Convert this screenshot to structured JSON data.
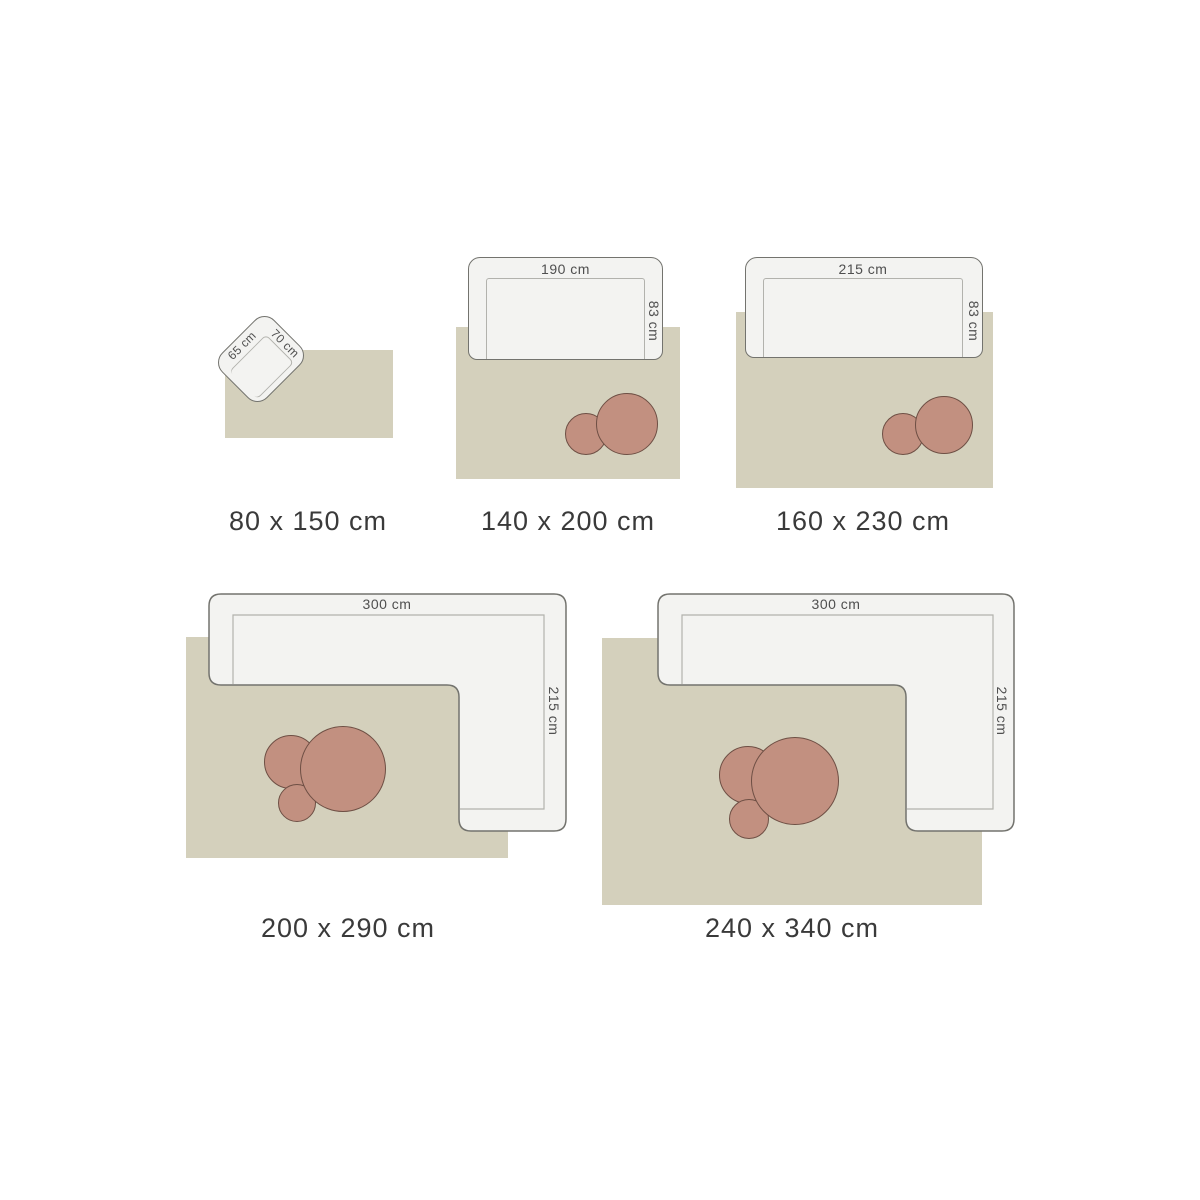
{
  "title": "Rug size guide diagram",
  "colors": {
    "background": "#ffffff",
    "rug_fill": "#d4d0bc",
    "sofa_fill": "#f3f3f1",
    "sofa_border": "#73736e",
    "seat_line": "#b2b2ad",
    "table_fill": "#c29080",
    "table_border": "#6e4f44",
    "size_label_text": "#3a3a3a",
    "dimension_text": "#4f4f4f"
  },
  "items": [
    {
      "size_label": "80 x 150 cm",
      "furniture": "armchair",
      "chair_width_label": "70 cm",
      "chair_depth_label": "65 cm"
    },
    {
      "size_label": "140 x 200 cm",
      "furniture": "sofa",
      "sofa_width_label": "190 cm",
      "sofa_depth_label": "83 cm"
    },
    {
      "size_label": "160 x 230 cm",
      "furniture": "sofa",
      "sofa_width_label": "215 cm",
      "sofa_depth_label": "83 cm"
    },
    {
      "size_label": "200 x 290 cm",
      "furniture": "sectional-sofa",
      "sofa_width_label": "300 cm",
      "sofa_depth_label": "215 cm"
    },
    {
      "size_label": "240 x 340 cm",
      "furniture": "sectional-sofa",
      "sofa_width_label": "300 cm",
      "sofa_depth_label": "215 cm"
    }
  ]
}
